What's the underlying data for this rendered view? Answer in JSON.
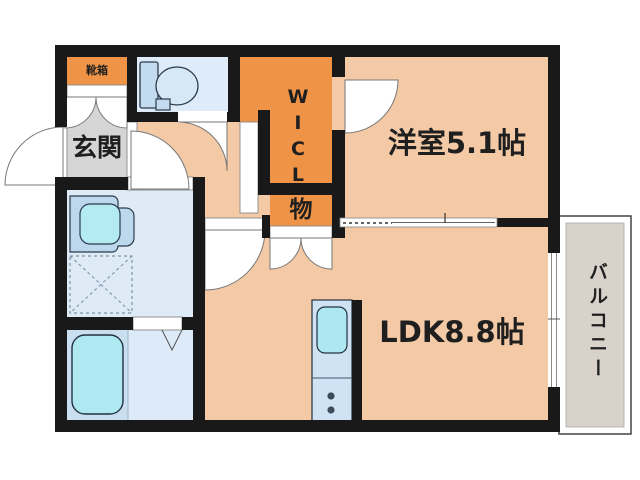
{
  "rooms": {
    "entrance": {
      "label": "玄関",
      "floor_color": "#d5d5d5"
    },
    "shoe_cabinet": {
      "label": "靴箱",
      "floor_color": "#ef9446"
    },
    "toilet": {
      "label": "",
      "floor_color": "#deebf8"
    },
    "walk_in_closet": {
      "label": "WICL",
      "floor_color": "#ef9446",
      "orientation": "vertical"
    },
    "storage": {
      "label": "物",
      "floor_color": "#ef9446"
    },
    "western_room": {
      "label": "洋室5.1帖",
      "floor_color": "#f3c9a6"
    },
    "ldk": {
      "label": "LDK8.8帖",
      "floor_color": "#f3c9a6"
    },
    "washroom": {
      "label": "",
      "floor_color": "#deebf7"
    },
    "bathroom": {
      "label": "",
      "floor_color": "#c9dff0"
    },
    "balcony": {
      "label": "バルコニー",
      "floor_color": "#d8d2cb",
      "orientation": "vertical"
    }
  },
  "fixtures": [
    {
      "name": "toilet-icon"
    },
    {
      "name": "vanity-sink-icon"
    },
    {
      "name": "washing-machine-pan-icon"
    },
    {
      "name": "bathtub-icon"
    },
    {
      "name": "kitchen-sink-icon"
    },
    {
      "name": "stove-burners-icon"
    }
  ],
  "colors": {
    "wall": "#191919",
    "room_salmon": "#f3c9a6",
    "room_orange": "#ef9446",
    "room_gray": "#d5d5d5",
    "room_lightblue": "#deebf8",
    "fixture_blue": "#c3dbef",
    "fixture_cyan": "#b4ebf2",
    "balcony_gray": "#d8d2cb",
    "text": "#1f1f1f"
  }
}
